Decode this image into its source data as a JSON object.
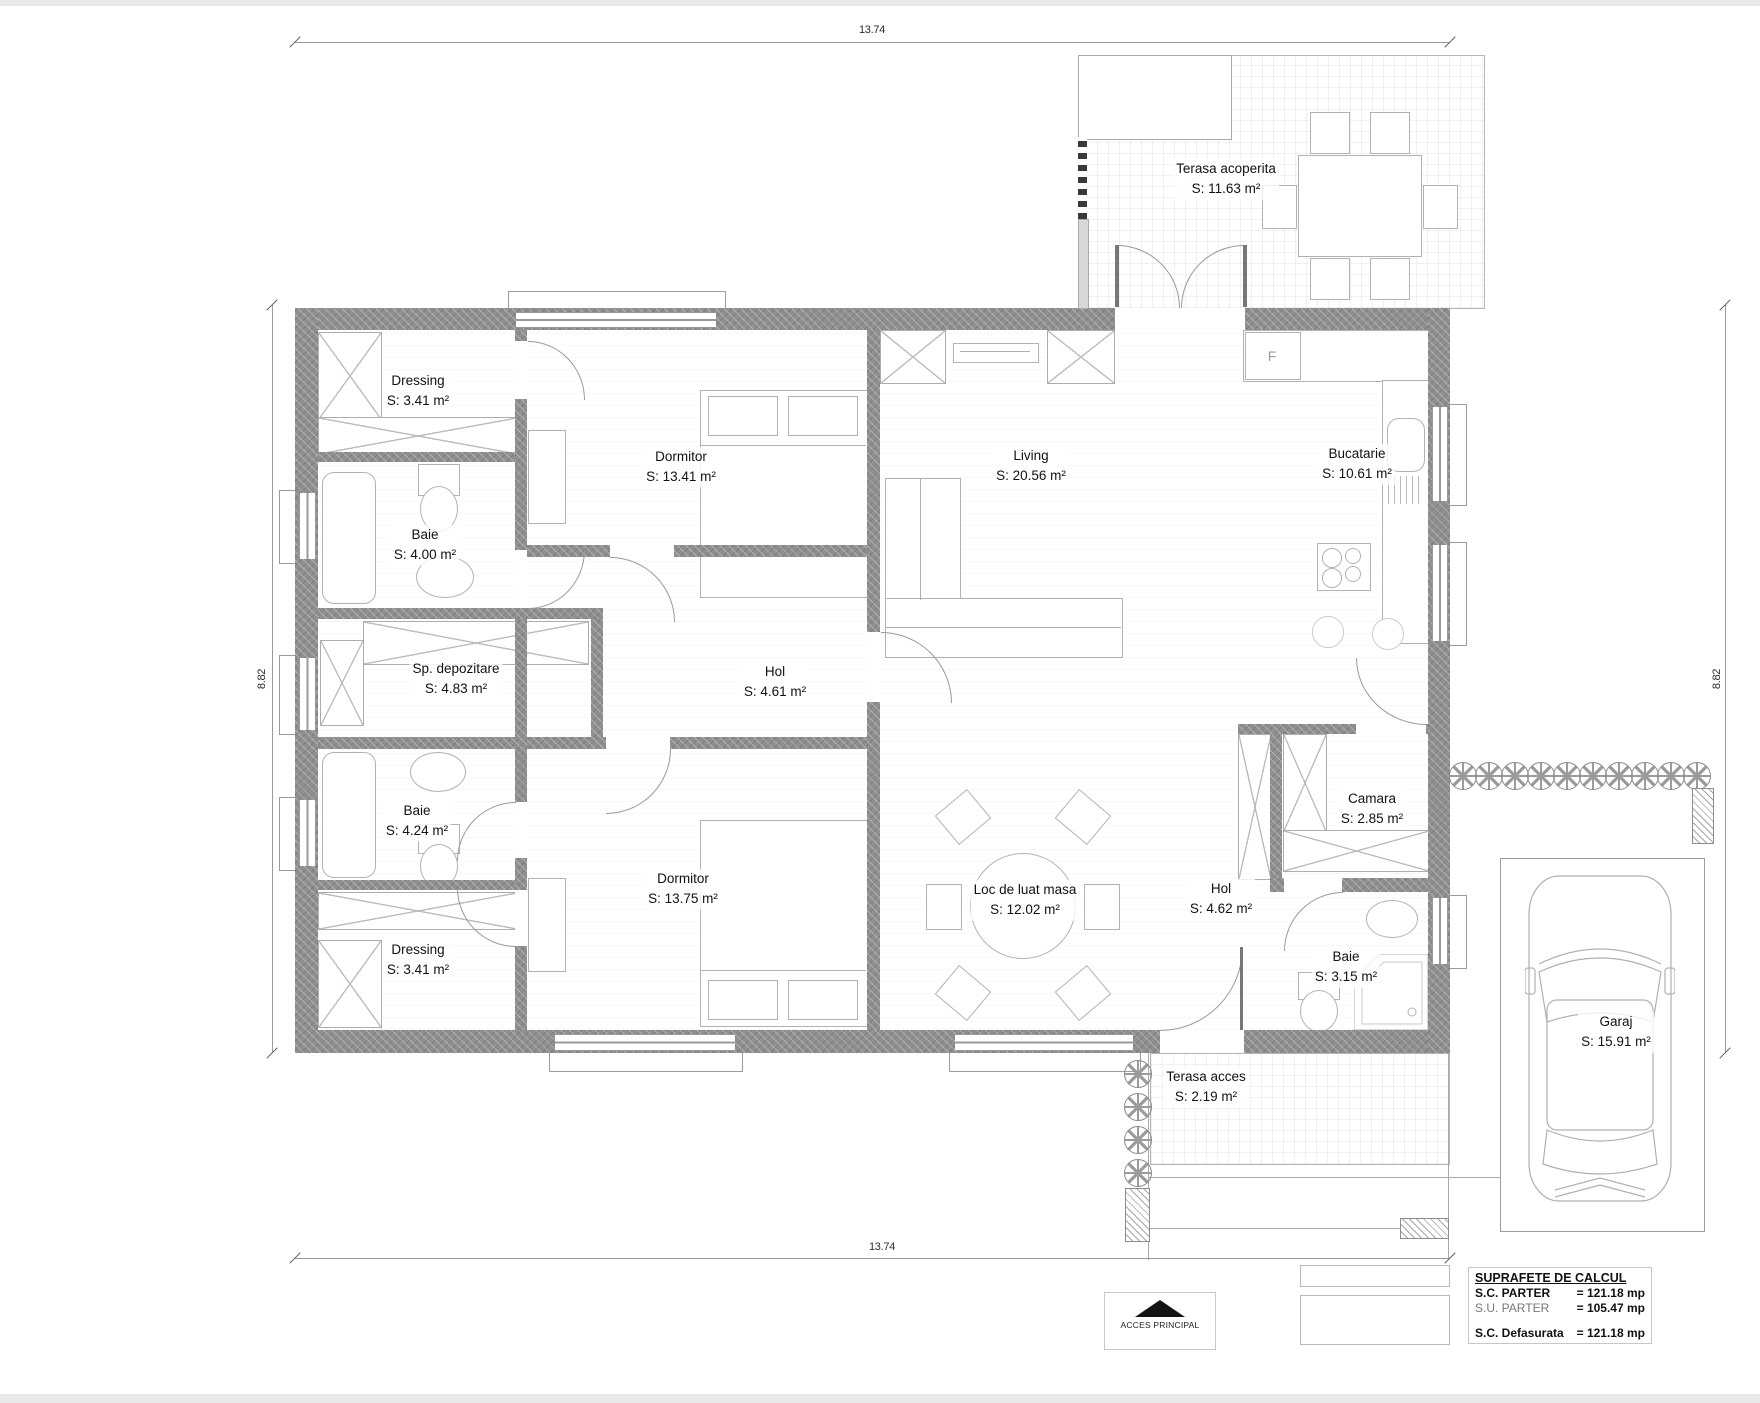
{
  "dimensions": {
    "top": "13.74",
    "bottom": "13.74",
    "left": "8.82",
    "right": "8.82"
  },
  "rooms": [
    {
      "name": "Dressing",
      "area": "S: 3.41 m²"
    },
    {
      "name": "Baie",
      "area": "S: 4.00 m²"
    },
    {
      "name": "Sp. depozitare",
      "area": "S: 4.83 m²"
    },
    {
      "name": "Baie",
      "area": "S: 4.24 m²"
    },
    {
      "name": "Dressing",
      "area": "S: 3.41 m²"
    },
    {
      "name": "Dormitor",
      "area": "S: 13.41 m²"
    },
    {
      "name": "Hol",
      "area": "S: 4.61 m²"
    },
    {
      "name": "Dormitor",
      "area": "S: 13.75 m²"
    },
    {
      "name": "Living",
      "area": "S: 20.56 m²"
    },
    {
      "name": "Bucatarie",
      "area": "S: 10.61 m²"
    },
    {
      "name": "Camara",
      "area": "S: 2.85 m²"
    },
    {
      "name": "Hol",
      "area": "S: 4.62 m²"
    },
    {
      "name": "Loc de luat masa",
      "area": "S: 12.02 m²"
    },
    {
      "name": "Baie",
      "area": "S: 3.15 m²"
    },
    {
      "name": "Terasa acoperita",
      "area": "S: 11.63 m²"
    },
    {
      "name": "Terasa acces",
      "area": "S: 2.19 m²"
    },
    {
      "name": "Garaj",
      "area": "S: 15.91 m²"
    }
  ],
  "kitchen": {
    "fridge_label": "F"
  },
  "legend": {
    "title": "SUPRAFETE DE CALCUL",
    "rows": [
      {
        "label": "S.C. PARTER",
        "value": "= 121.18 mp"
      },
      {
        "label": "S.U. PARTER",
        "value": "= 105.47 mp"
      },
      {
        "label": "S.C. Defasurata",
        "value": "= 121.18 mp"
      }
    ]
  },
  "access": {
    "label": "ACCES PRINCIPAL"
  }
}
